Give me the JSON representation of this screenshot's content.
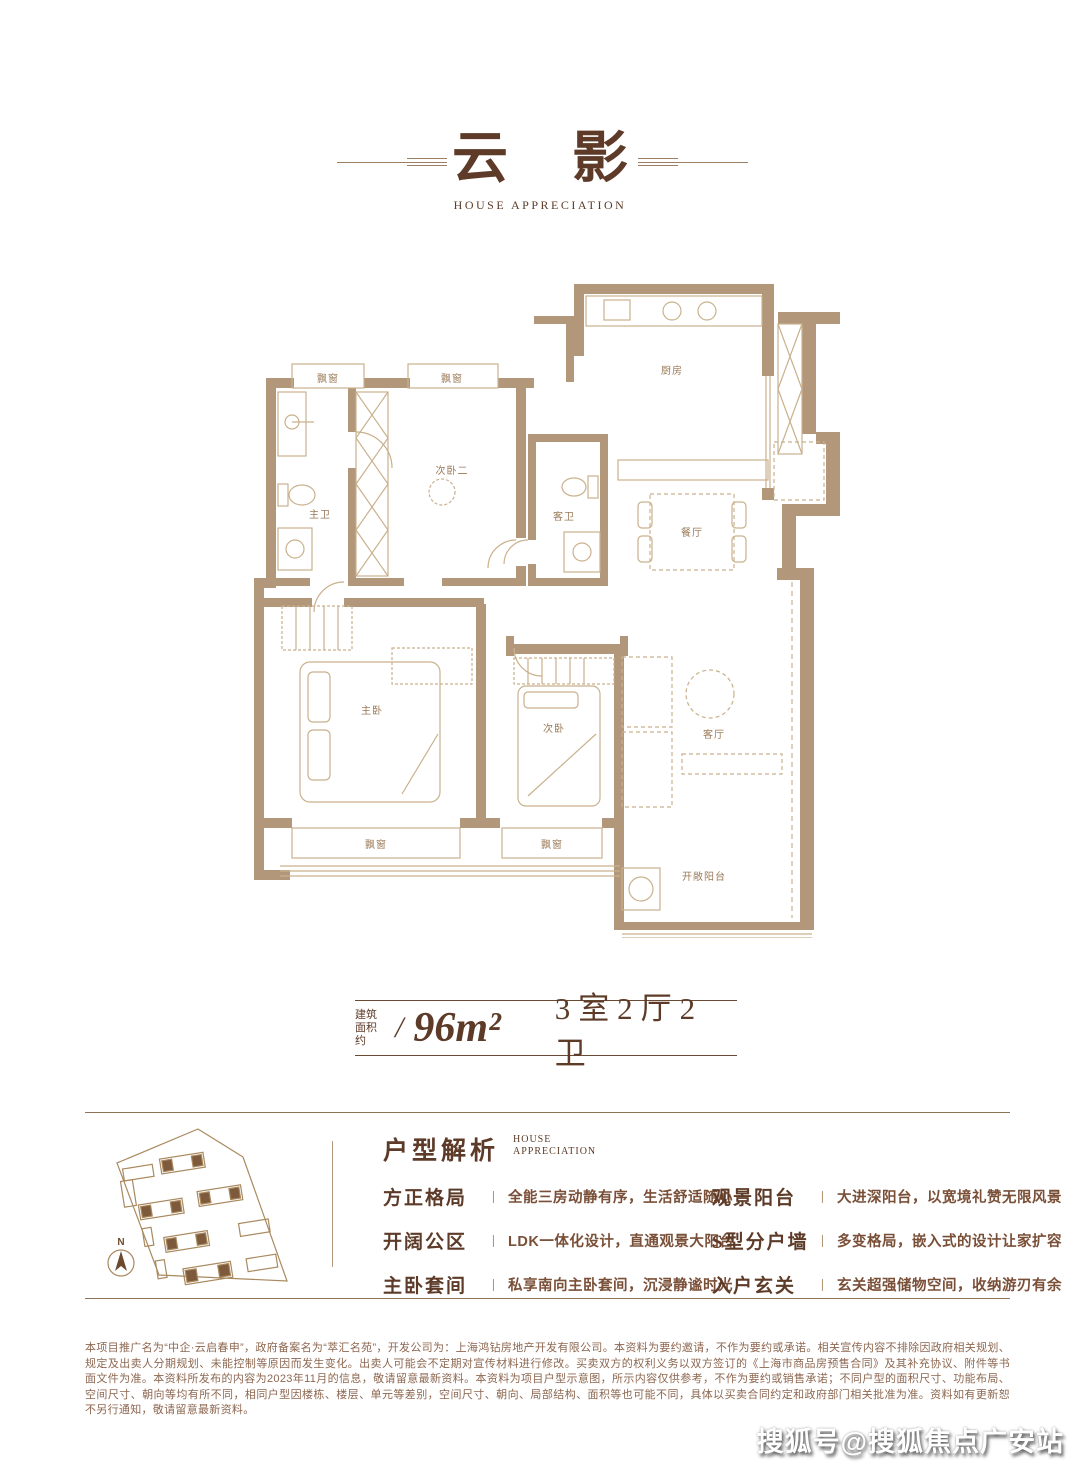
{
  "title": {
    "char1": "云",
    "char2": "影",
    "subtitle": "HOUSE APPRECIATION"
  },
  "floorplan": {
    "rooms": [
      {
        "id": "bay-window-1",
        "label": "飘窗"
      },
      {
        "id": "bay-window-2",
        "label": "飘窗"
      },
      {
        "id": "master-bath",
        "label": "主卫"
      },
      {
        "id": "bedroom-2",
        "label": "次卧二"
      },
      {
        "id": "guest-bath",
        "label": "客卫"
      },
      {
        "id": "kitchen",
        "label": "厨房"
      },
      {
        "id": "dining-room",
        "label": "餐厅"
      },
      {
        "id": "master-bedroom",
        "label": "主卧"
      },
      {
        "id": "bedroom",
        "label": "次卧"
      },
      {
        "id": "living-room",
        "label": "客厅"
      },
      {
        "id": "bay-window-3",
        "label": "飘窗"
      },
      {
        "id": "bay-window-4",
        "label": "飘窗"
      },
      {
        "id": "open-balcony",
        "label": "开敞阳台"
      }
    ],
    "colors": {
      "wall": "#b2977a",
      "line": "#c9b18d",
      "label": "#9b7a57"
    }
  },
  "spec": {
    "prefix_top": "建筑",
    "prefix_bottom": "面积约",
    "separator": "/",
    "area": "96m²",
    "rooms": "3室2厅2卫"
  },
  "analysis": {
    "heading": "户型解析",
    "heading_en_top": "HOUSE",
    "heading_en_bottom": "APPRECIATION",
    "features_left": [
      {
        "title": "方正格局",
        "divider": "丨",
        "desc": "全能三房动静有序，生活舒适随心"
      },
      {
        "title": "开阔公区",
        "divider": "丨",
        "desc": "LDK一体化设计，直通观景大阳台"
      },
      {
        "title": "主卧套间",
        "divider": "丨",
        "desc": "私享南向主卧套间，沉浸静谧时光"
      }
    ],
    "features_right": [
      {
        "title": "观景阳台",
        "divider": "丨",
        "desc": "大进深阳台，以宽境礼赞无限风景"
      },
      {
        "title": "S型分户墙",
        "divider": "丨",
        "desc": "多变格局，嵌入式的设计让家扩容"
      },
      {
        "title": "入户玄关",
        "divider": "丨",
        "desc": "玄关超强储物空间，收纳游刃有余"
      }
    ]
  },
  "siteplan": {
    "north": "N"
  },
  "disclaimer": "本项目推广名为“中企·云启春申”，政府备案名为“萃汇名苑”，开发公司为：上海鸿钻房地产开发有限公司。本资料为要约邀请，不作为要约或承诺。相关宣传内容不排除因政府相关规划、规定及出卖人分期规划、未能控制等原因而发生变化。出卖人可能会不定期对宣传材料进行修改。买卖双方的权利义务以双方签订的《上海市商品房预售合同》及其补充协议、附件等书面文件为准。本资料所发布的内容为2023年11月的信息，敬请留意最新资料。本资料为项目户型示意图，所示内容仅供参考，不作为要约或销售承诺；不同户型的面积尺寸、功能布局、空间尺寸、朝向等均有所不同，相同户型因楼栋、楼层、单元等差别，空间尺寸、朝向、局部结构、面积等也可能不同，具体以买卖合同约定和政府部门相关批准为准。资料如有更新恕不另行通知，敬请留意最新资料。",
  "watermark": "搜狐号@搜狐焦点广安站"
}
